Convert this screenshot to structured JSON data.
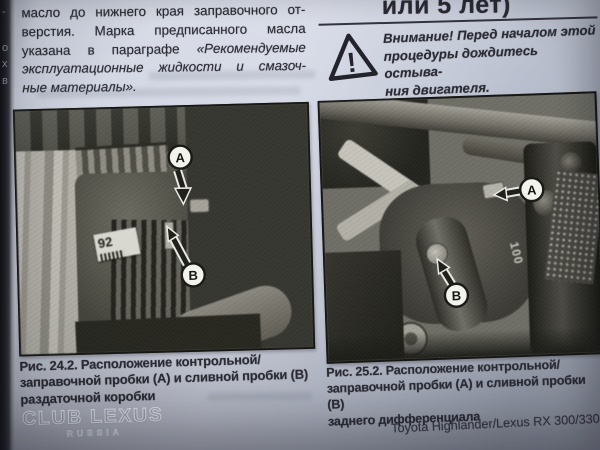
{
  "colors": {
    "paper": "#d4d8e4",
    "ink": "#2b2b33",
    "photo_gray": "#57574f",
    "marker_fill": "#f3f3ee",
    "marker_stroke": "#1a1a16"
  },
  "gutter_fragments": [
    "-",
    "о",
    "х",
    "в"
  ],
  "left_column": {
    "line1": "масло до нижнего края заправочного от-",
    "line2": "верстия. Марка предписанного масла",
    "line3_normal": "указана в параграфе",
    "line3_italic": "«Рекомендуемые",
    "line4": "эксплуатационные жидкости и смазоч-",
    "line5": "ные материалы»."
  },
  "right_column": {
    "heading": "или 5 лет)",
    "warning_lines": [
      "Внимание! Перед началом этой",
      "процедуры дождитесь остыва-",
      "ния двигателя."
    ],
    "warning_glyph": "!"
  },
  "figures": {
    "left": {
      "label_a": "A",
      "label_b": "B",
      "sticker": "92",
      "caption": [
        "Рис. 24.2. Расположение контрольной/",
        "заправочной пробки (А) и сливной пробки (В)",
        "раздаточной коробки"
      ]
    },
    "right": {
      "label_a": "A",
      "label_b": "B",
      "part_marking": "100",
      "caption": [
        "Рис. 25.2. Расположение контрольной/",
        "заправочной пробки (А) и сливной пробки (В)",
        "заднего дифференциала"
      ]
    }
  },
  "watermark": {
    "line1": "CLUB LEXUS",
    "line2": "RUSSIA"
  },
  "footer": "Toyota Highlander/Lexus RX 300/330"
}
